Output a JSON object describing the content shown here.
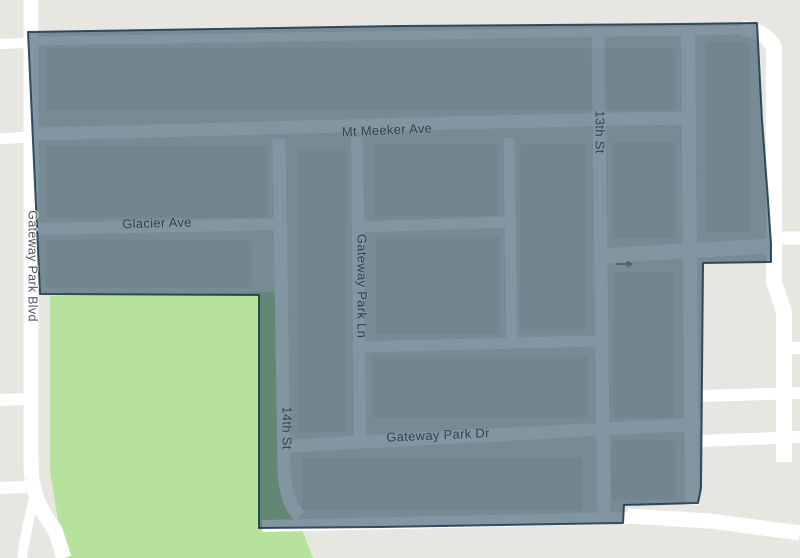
{
  "map": {
    "description": "Street map with selected region overlay",
    "colors": {
      "background": "#e8e6e1",
      "road": "#ffffff",
      "park": "#b7e29c",
      "overlay_fill": "rgba(28,62,84,0.55)",
      "overlay_stroke": "#16364d",
      "label_dark": "#33424b",
      "label_gray": "#53585c",
      "arrow": "#4d6572",
      "block_shade": "rgba(10,30,45,0.05)"
    },
    "labels": [
      {
        "text": "Mt Meeker Ave",
        "orientation": "horizontal"
      },
      {
        "text": "Glacier Ave",
        "orientation": "horizontal"
      },
      {
        "text": "Gateway Park Dr",
        "orientation": "horizontal"
      },
      {
        "text": "Gateway Park Ln",
        "orientation": "vertical"
      },
      {
        "text": "Gateway Park Blvd",
        "orientation": "vertical"
      },
      {
        "text": "13th St",
        "orientation": "vertical"
      },
      {
        "text": "14th St",
        "orientation": "vertical"
      }
    ],
    "one_way_arrow": {
      "symbol": "→",
      "direction": "east"
    }
  }
}
